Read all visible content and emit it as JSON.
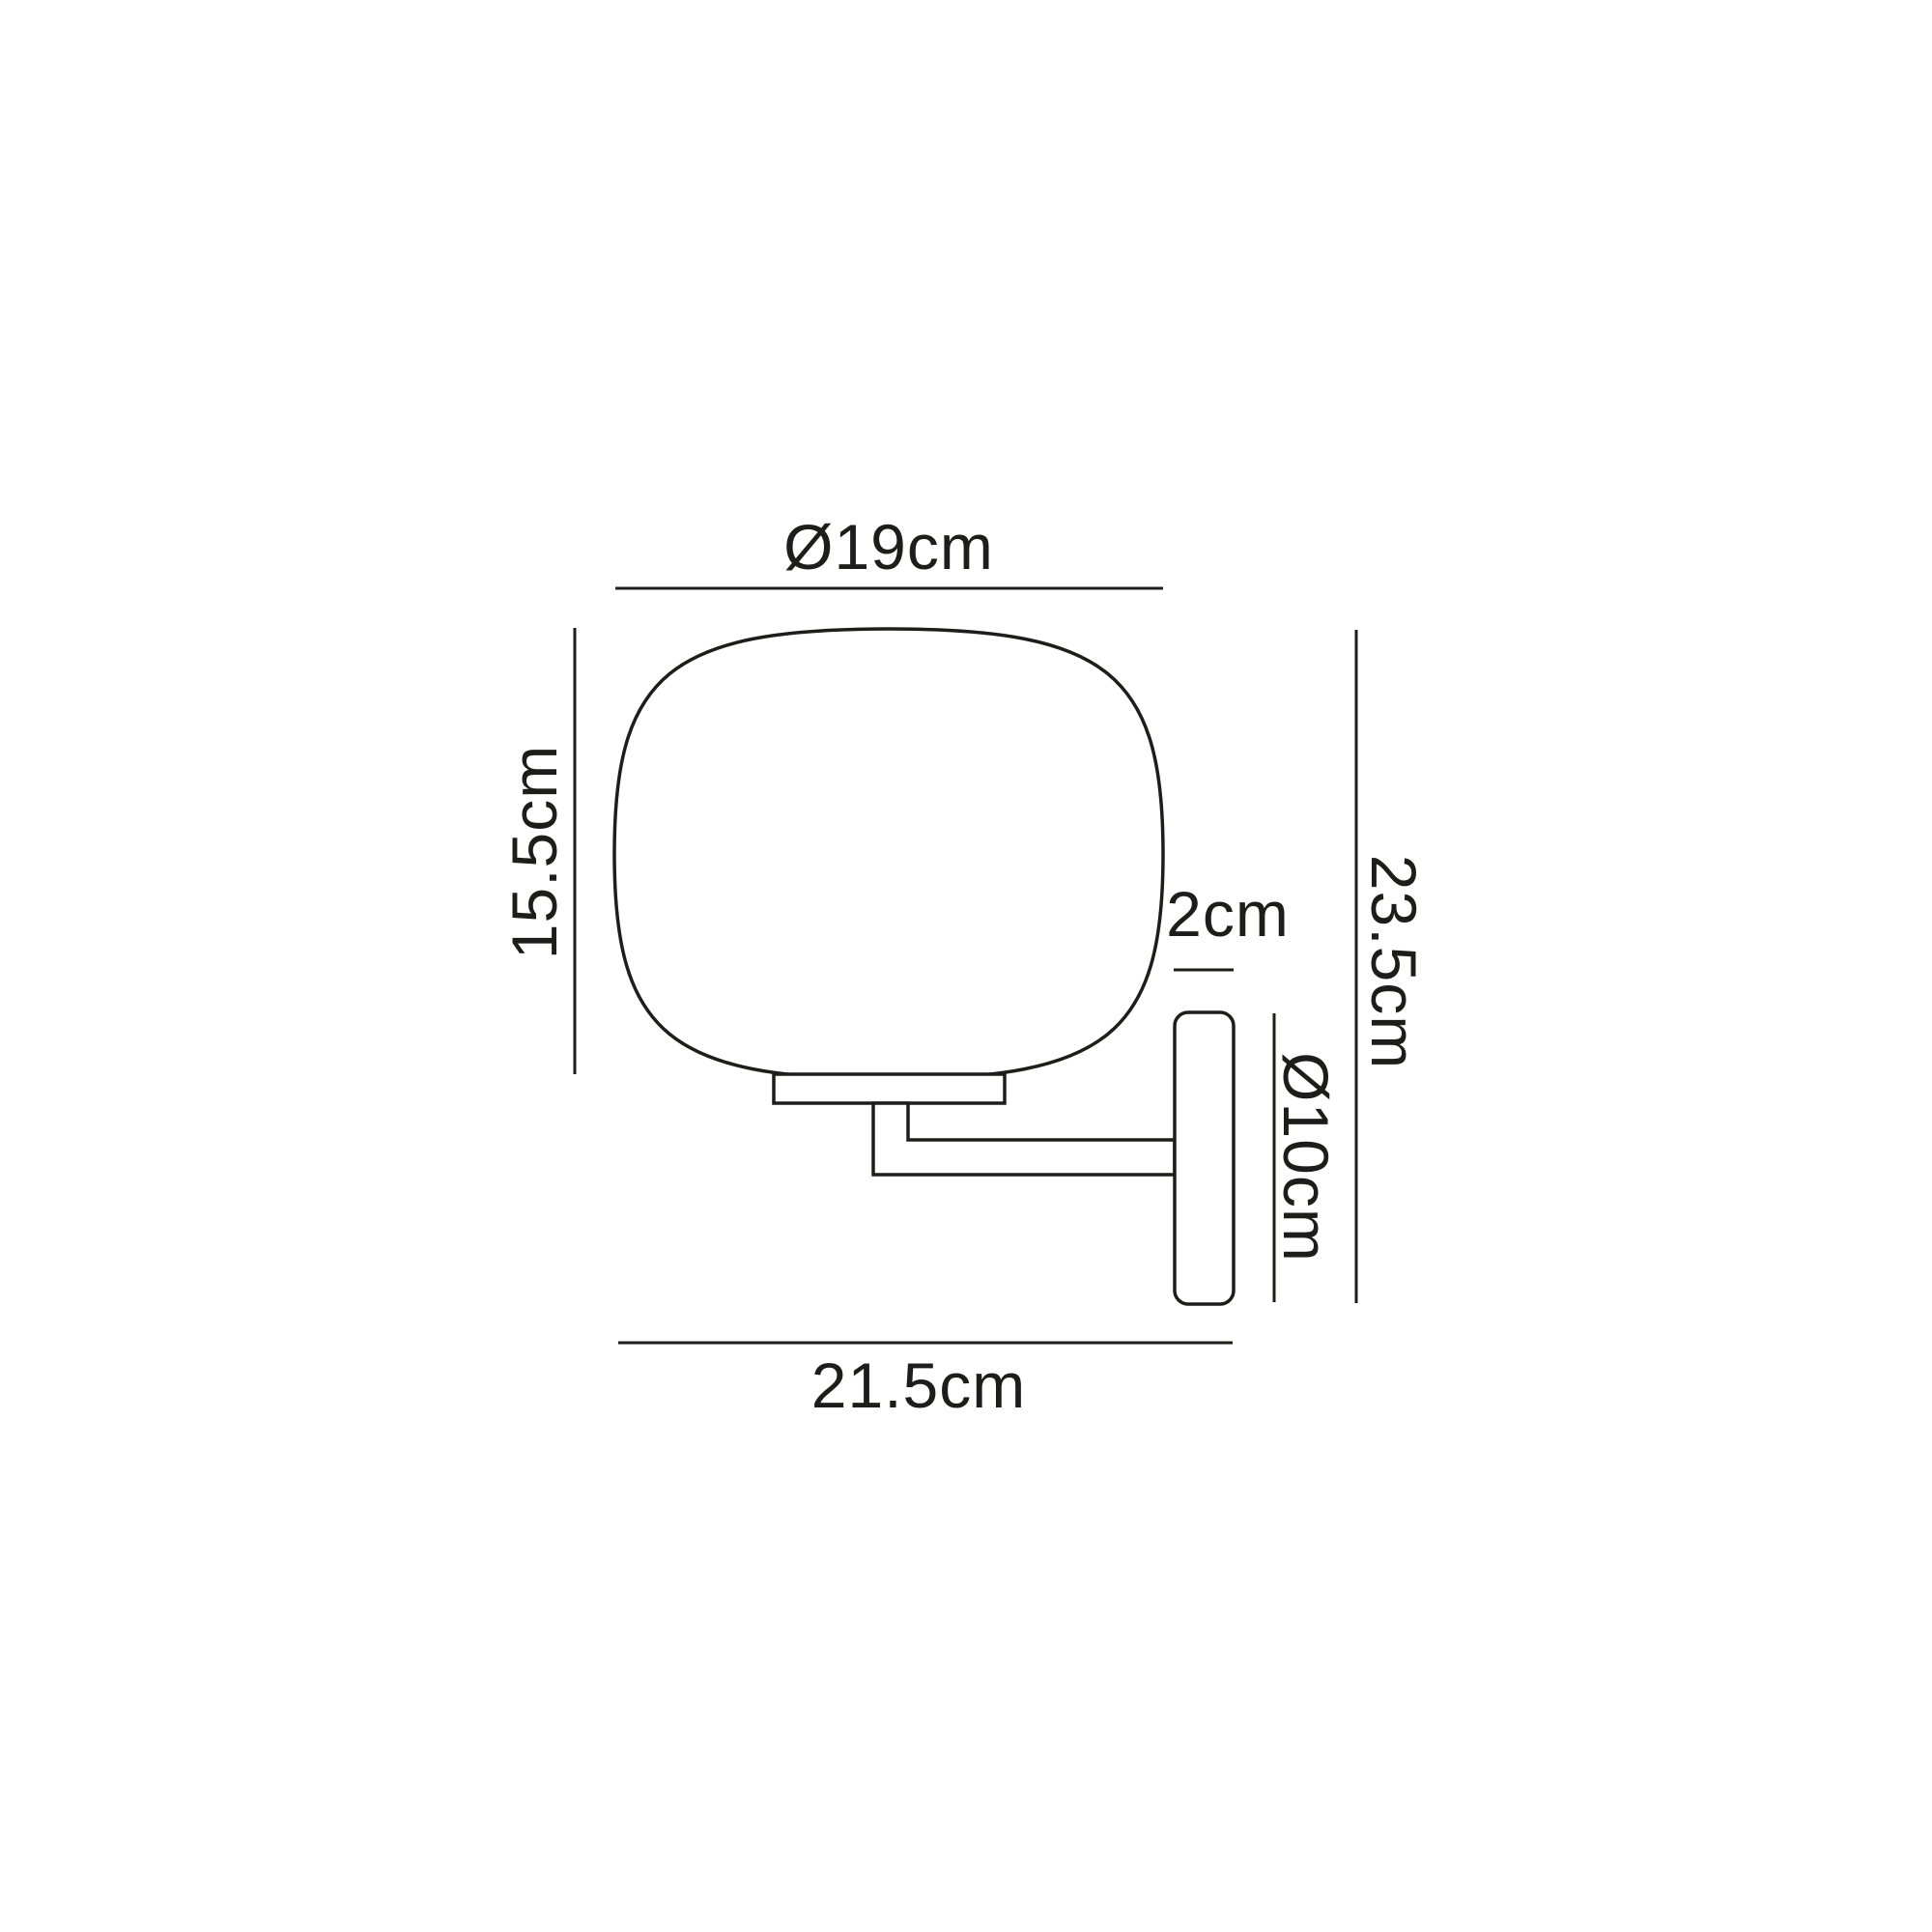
{
  "diagram": {
    "kind": "wall-lamp dimension drawing",
    "colors": {
      "line": "#1d1d1b",
      "background": "#ffffff"
    },
    "labels": {
      "shade_diameter": "Ø19cm",
      "shade_height": "15.5cm",
      "backplate_depth": "2cm",
      "overall_height": "23.5cm",
      "backplate_diameter": "Ø10cm",
      "overall_depth": "21.5cm"
    }
  }
}
